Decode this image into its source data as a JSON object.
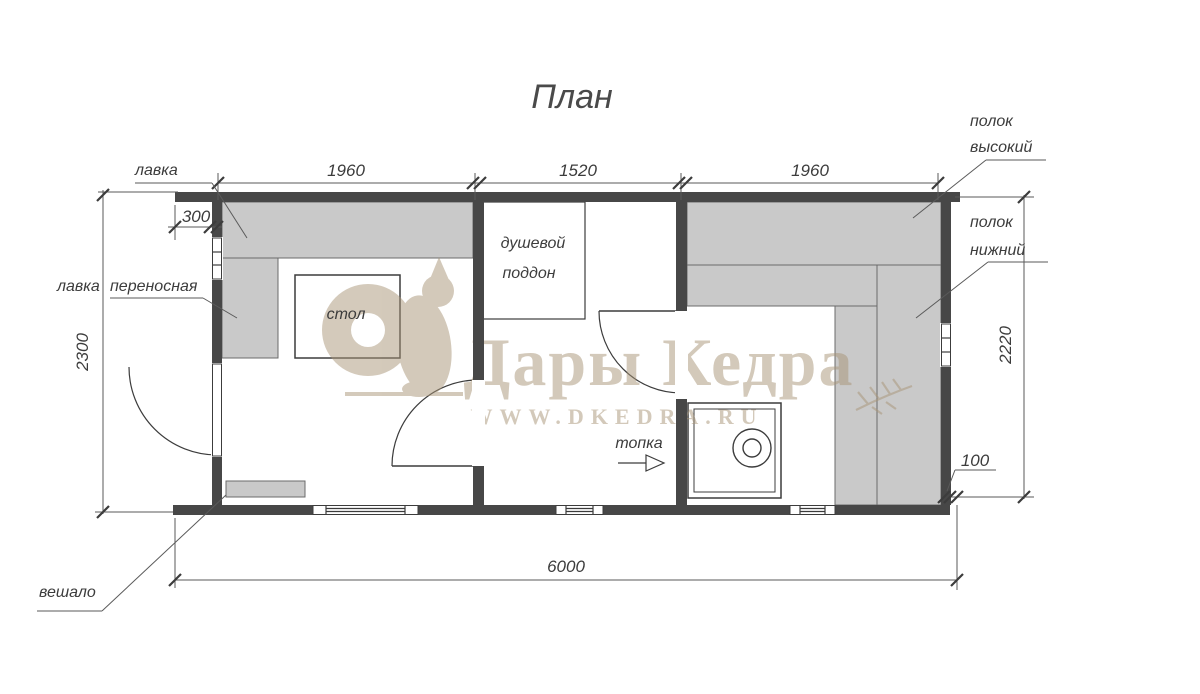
{
  "title": "План",
  "dims": {
    "seg1": "1960",
    "seg2": "1520",
    "seg3": "1960",
    "inset_left": "300",
    "width_outer": "2300",
    "width_inner": "2220",
    "inset_right": "100",
    "length_total": "6000"
  },
  "labels": {
    "bench": "лавка",
    "bench_portable_word1": "лавка",
    "bench_portable_word2": "переносная",
    "table": "стол",
    "shower_line1": "душевой",
    "shower_line2": "поддон",
    "firebox": "топка",
    "hanger": "вешало",
    "shelf_high_line1": "полок",
    "shelf_high_line2": "высокий",
    "shelf_low_line1": "полок",
    "shelf_low_line2": "нижний"
  },
  "watermark": {
    "brand": "Дары Кедра",
    "website": "WWW.DKEDRA.RU"
  },
  "colors": {
    "wall": "#474747",
    "furniture": "#c9c9c9",
    "line": "#3c3c3c",
    "watermark": "#a99577",
    "background": "#ffffff"
  }
}
